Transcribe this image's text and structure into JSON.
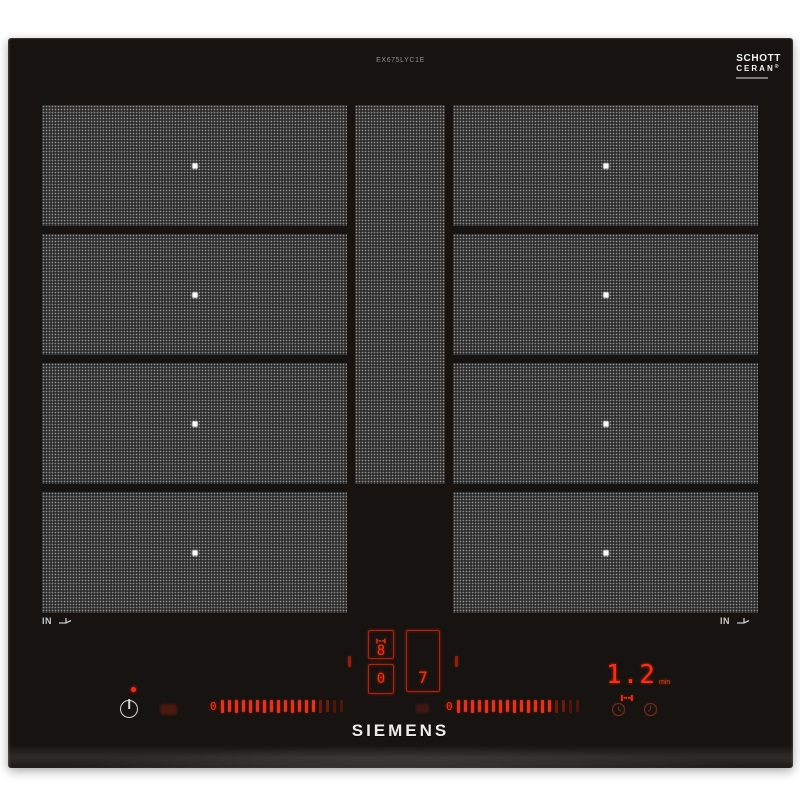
{
  "hob": {
    "model_label": "EX675LYC1E",
    "brand": "SIEMENS",
    "schott": {
      "line1": "SCHOTT",
      "line2": "CERAN",
      "registered": "®"
    },
    "markers": {
      "left": "IN",
      "right": "IN"
    },
    "display": {
      "bridge_rear_level": "8",
      "bridge_front_level": "0",
      "right_zone_level": "7",
      "timer_value": "1.2",
      "timer_unit": "min"
    },
    "sliders": {
      "left": {
        "zero_label": "0",
        "bar_count": 18
      },
      "right": {
        "zero_label": "0",
        "bar_count": 18
      }
    },
    "colors": {
      "led_red": "#ff2c12",
      "glass_black": "#171310",
      "zone_gray": "#3d3d3d"
    }
  }
}
